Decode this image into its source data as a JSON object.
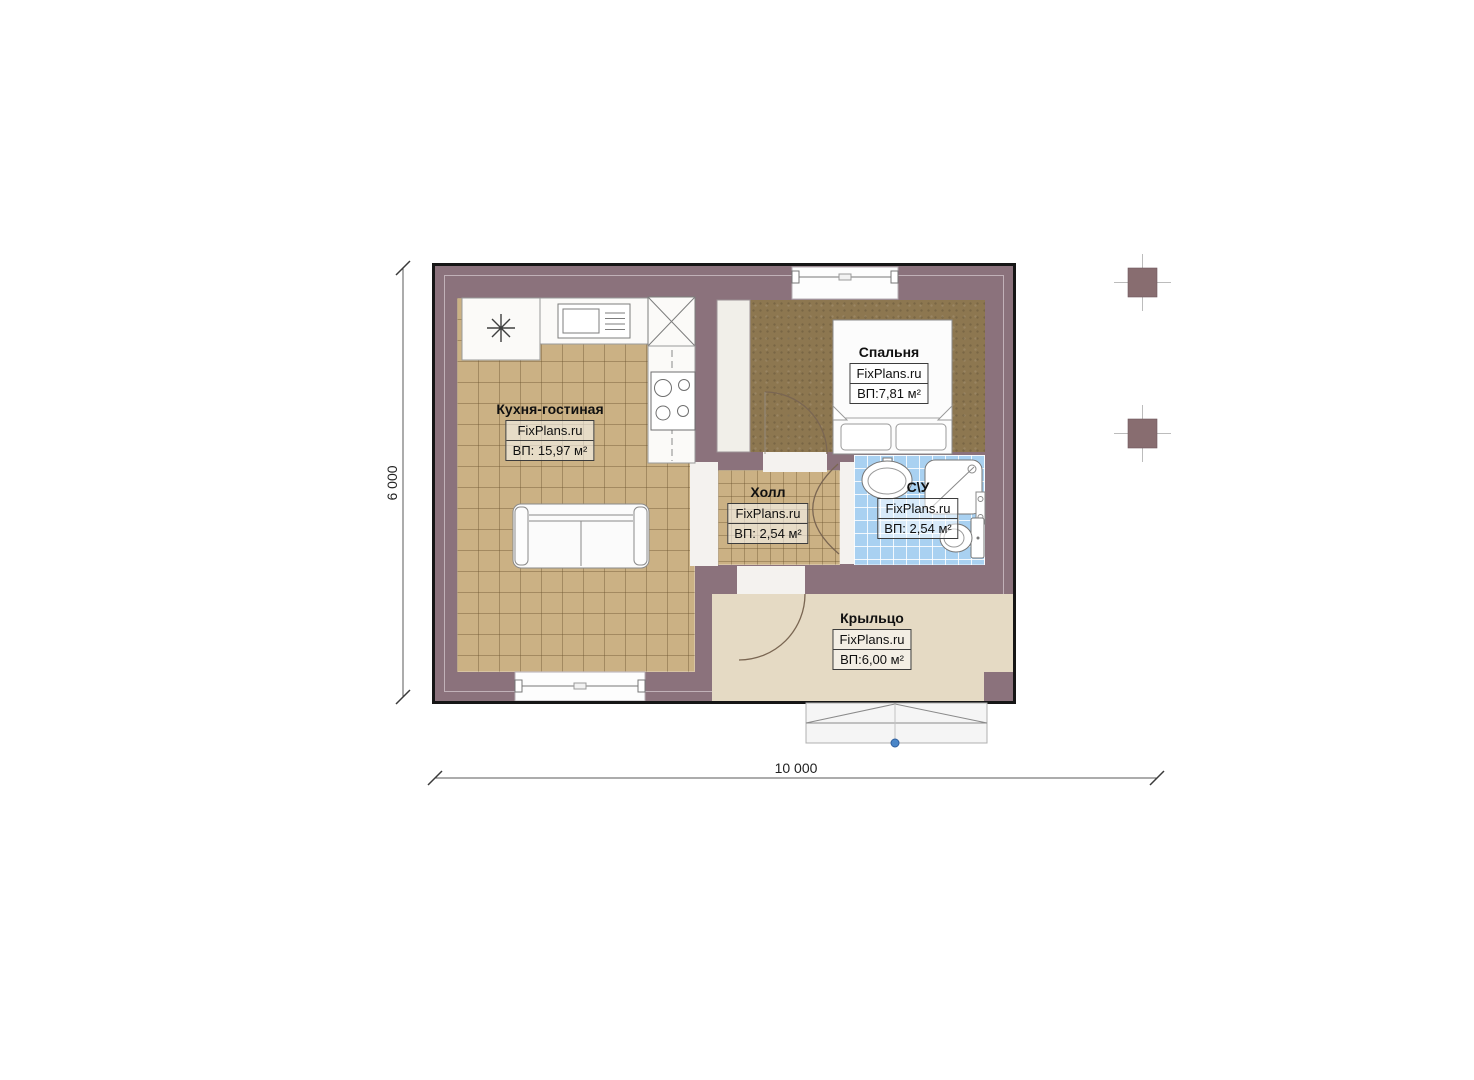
{
  "rooms": {
    "kitchen": {
      "name": "Кухня-гостиная",
      "watermark": "FixPlans.ru",
      "area": "ВП: 15,97 м²"
    },
    "bedroom": {
      "name": "Спальня",
      "watermark": "FixPlans.ru",
      "area": "ВП:7,81 м²"
    },
    "hall": {
      "name": "Холл",
      "watermark": "FixPlans.ru",
      "area": "ВП: 2,54 м²"
    },
    "bathroom": {
      "name": "С\\У",
      "watermark": "FixPlans.ru",
      "area": "ВП: 2,54 м²"
    },
    "porch": {
      "name": "Крыльцо",
      "watermark": "FixPlans.ru",
      "area": "ВП:6,00 м²"
    }
  },
  "dimensions": {
    "height_label": "6 000",
    "width_label": "10 000"
  },
  "colors": {
    "wall": "#8b727c",
    "tile": "#cbb184",
    "bedroom_floor": "#8d7750",
    "bath_tile": "#a9d1f1",
    "porch_floor": "#e5dac4",
    "marker_blue": "#4a86c8"
  },
  "fixtures": [
    "kitchen-table",
    "kitchen-sink",
    "corner-cabinet",
    "stove",
    "wardrobe",
    "sofa",
    "bed",
    "wash-basin",
    "shower",
    "towel-rail",
    "toilet",
    "entrance-steps",
    "site-columns"
  ]
}
